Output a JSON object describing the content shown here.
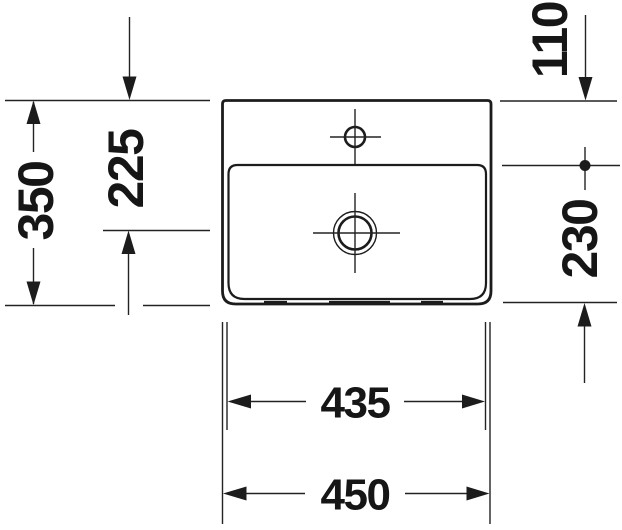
{
  "drawing": {
    "type": "washbasin-top-view-technical-drawing",
    "background_color": "#ffffff",
    "line_color": "#1c1c1c",
    "dimensions": {
      "overall_depth": "350",
      "tap_to_drain": "225",
      "back_edge_to_bowl": "110",
      "bowl_to_front": "230",
      "bowl_width": "435",
      "overall_width": "450"
    }
  }
}
